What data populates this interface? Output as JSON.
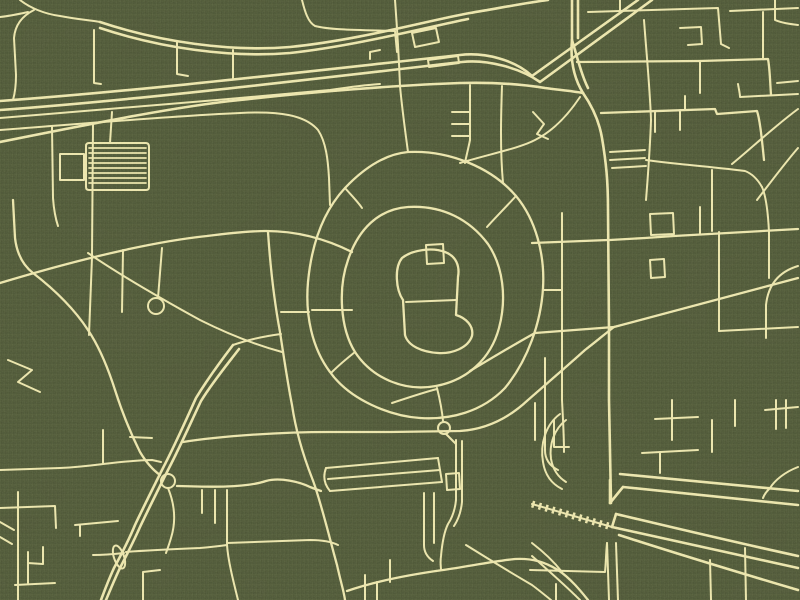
{
  "meta": {
    "description": "Stylized city street map art print, gold road network on olive-green canvas, no labels",
    "visible_text": []
  },
  "canvas": {
    "width": 800,
    "height": 600,
    "background_color": "#4e5736",
    "road_color": "#ebe5ac",
    "texture": "canvas-weave"
  },
  "map": {
    "layers": [
      {
        "name": "motorway-road",
        "stroke_width": 2.6,
        "paths": [
          "M0,101 C150,90 320,70 460,55 C485,52 515,60 532,76 L638,0",
          "M0,110 C150,99 320,78 462,62 C487,59 520,68 540,82 L652,0",
          "M100,22 C160,42 230,52 290,47 C360,40 430,20 470,13 C500,8 525,3 548,0",
          "M100,28 C160,48 230,58 290,53 C355,46 428,27 468,19",
          "M233,345 C220,362 207,380 196,398 C186,420 175,445 163,468 C152,490 143,508 135,525 C128,542 121,555 114,568 C108,581 104,592 101,600",
          "M239,349 C226,366 212,383 201,401 C191,422 180,447 168,470 C157,492 148,510 140,527 C132,545 125,558 119,570 C113,583 109,593 106,600",
          "M583,93 C592,106 599,120 602,138 C606,162 608,180 608,210 L609,330 L609,400 L611,503",
          "M0,142 C100,122 180,106 240,100 C310,92 400,85 460,83 C495,82 520,84 545,88 C560,90 572,91 583,93",
          "M572,0 L572,40 C570,62 575,80 583,93",
          "M578,0 L578,38",
          "M572,40 C578,60 582,76 588,88",
          "M620,474 L798,491",
          "M623,487 L798,505",
          "M612,527 C640,533 700,547 798,568",
          "M616,514 C650,522 720,539 798,556",
          "M619,535 C650,545 720,567 798,590",
          "M610,480 L610,503",
          "M612,527 L616,514",
          "M610,503 L623,487"
        ]
      },
      {
        "name": "primary-road",
        "stroke_width": 2.3,
        "paths": [
          "M408,152 C450,150 492,168 516,196 C536,220 545,255 543,288 C541,322 528,360 505,388 C482,412 450,420 420,418 C390,416 350,400 330,372 C312,348 305,315 308,282 C311,250 320,215 345,188 C365,167 386,154 408,152 Z",
          "M408,207 C443,205 470,220 488,244 C503,266 507,298 499,328 C491,358 468,380 436,386 C404,392 372,378 355,352 C340,328 338,288 348,260 C358,230 378,209 408,207 Z",
          "M402,258 C412,250 432,247 445,252 C456,256 460,266 458,277 L456,315 C466,318 474,326 472,336 C468,348 452,354 438,353 C422,352 408,346 405,335 L403,300 C396,290 394,268 402,258 Z",
          "M0,283 C60,265 140,243 207,236 C230,233 250,231 266,231 C290,231 320,236 352,252",
          "M268,232 C270,262 274,300 280,332 C285,365 288,385 292,405 C296,432 303,455 312,478 C320,498 330,540 337,565 C341,583 344,592 345,600",
          "M13,200 L15,238 C17,255 24,266 33,273 C55,290 75,310 88,330 C100,348 108,368 115,390 C122,412 130,432 140,452 C146,462 153,470 160,475",
          "M183,442 C220,436 280,432 330,432 L390,432 L460,431 C490,429 512,415 528,400 C545,385 565,368 585,350 C598,340 606,333 614,327",
          "M470,371 C495,356 515,344 535,333 L614,327 L798,278",
          "M347,591 C370,583 400,576 443,570 C470,566 495,561 515,559 C532,558 545,562 558,570 C570,578 580,590 588,600",
          "M177,486 C210,487 245,488 266,481 C280,477 300,482 310,487 C315,489 318,490 321,491",
          "M532,243 L608,240 M610,240 L645,238 L674,236 L798,229",
          "M577,62 L700,61 L768,59 C770,70 770,82 771,95",
          "M601,113 L715,109 L717,114 L757,111 C760,120 762,140 764,160"
        ]
      },
      {
        "name": "minor-road",
        "stroke_width": 2.0,
        "paths": [
          "M52,127 L53,198 C54,212 56,220 58,226",
          "M93,125 L92,257 M92,257 L89,335",
          "M123,250 L122,312",
          "M88,253 C120,275 160,298 200,320 C230,335 260,346 282,352",
          "M158,298 L162,248",
          "M8,360 L32,370 L18,382 L40,392",
          "M0,118 C100,110 220,100 330,90 C350,87 365,85 380,84",
          "M0,130 C80,124 170,116 240,113 C280,111 305,115 318,130 C326,142 328,160 329,178 L330,205",
          "M89,143 L146,143 Q149,143 149,147 L149,187 Q149,190 146,190 L89,190 Q86,190 86,187 L86,146 Q86,143 89,143",
          "M60,154 L84,154 L84,180 L60,180 Z",
          "M110,143 L112,112",
          "M94,30 L94,83 L101,84",
          "M177,42 L177,74 L188,76",
          "M233,50 L233,79",
          "M20,0 C30,8 45,14 60,16 C75,19 88,20 100,22",
          "M34,10 C22,16 15,25 14,38 L16,75 C16,84 15,93 13,100",
          "M0,17 C10,16 19,14 28,12",
          "M302,0 C305,12 308,22 315,26 C330,30 360,30 395,31 L397,52",
          "M395,0 C398,40 399,60 400,86 C402,108 405,130 408,152",
          "M470,85 L470,140 M452,112 L470,112 M452,124 L470,124 M452,136 L470,136 M470,140 C468,150 466,157 465,163",
          "M460,163 C490,154 520,148 535,140 C555,130 570,112 580,97",
          "M502,86 C501,115 500,150 503,183",
          "M588,12 L718,8 C719,20 720,32 721,44 L729,48",
          "M620,0 L620,11",
          "M730,11 L798,8",
          "M763,12 L763,58",
          "M680,28 L701,27 L702,44 L688,45",
          "M644,20 C647,60 650,90 651,120 C650,150 648,175 646,200",
          "M700,62 L700,93",
          "M685,96 L685,110",
          "M738,84 C739,90 740,94 740,97 L798,94",
          "M777,83 L798,81",
          "M732,164 C755,145 775,126 798,109",
          "M757,200 C770,183 785,163 798,148",
          "M775,0 L775,20 C782,23 790,24 798,25",
          "M562,213 L562,400 C563,420 564,435 564,452",
          "M700,207 L700,234",
          "M719,232 L719,331",
          "M762,187 C766,196 768,212 769,232 L769,278",
          "M650,214 L673,213 L674,234 L651,235 Z",
          "M650,260 L664,259 L665,277 L651,278 Z",
          "M719,331 L798,327",
          "M798,266 C778,272 768,286 766,305 L766,338",
          "M543,290 L562,290",
          "M545,358 L545,450 C545,460 550,466 558,470",
          "M535,403 L535,440",
          "M554,420 L554,447 L569,447",
          "M642,453 L698,450 M660,452 L660,473",
          "M655,419 L698,417",
          "M672,400 L672,440",
          "M712,420 L712,452",
          "M735,400 L735,426",
          "M765,410 L798,407",
          "M776,400 L776,429 M786,400 L786,428",
          "M798,467 C785,472 775,480 770,488 C766,492 764,495 763,498",
          "M607,543 L609,600 M616,543 L618,600",
          "M530,570 L605,572 C606,562 606,553 607,543",
          "M556,584 L556,600",
          "M710,560 L711,600",
          "M745,548 L746,600",
          "M532,556 C550,572 565,585 580,600",
          "M532,543 C545,553 555,563 562,572",
          "M466,545 C490,560 515,575 532,585 C540,591 546,596 551,600",
          "M365,575 L365,600",
          "M377,582 L377,600",
          "M390,560 L390,582",
          "M424,493 L424,545 C424,552 427,557 433,561",
          "M434,493 L434,543",
          "M326,468 L438,458",
          "M328,479 L440,470",
          "M330,491 L442,482",
          "M438,458 L442,482 M326,468 C323,476 324,484 330,491",
          "M446,474 L459,473 L460,489 L447,490 Z",
          "M456,440 L456,500 C455,510 452,518 448,524 C444,532 442,545 441,556 C440,563 441,567 441,570",
          "M462,441 L462,502 C461,512 458,520 454,526",
          "M437,388 C440,400 442,410 443,421",
          "M446,434 C450,438 453,441 456,444",
          "M392,403 C410,397 425,392 437,389",
          "M560,414 C545,425 540,445 543,462 C545,475 552,484 562,489",
          "M566,420 C554,429 549,445 551,459 C553,470 558,477 566,482",
          "M168,488 C175,505 176,522 171,538 C169,545 167,550 166,553",
          "M93,555 C105,555 115,554 124,553",
          "M126,552 C150,550 175,549 200,548 C212,547 220,546 227,545",
          "M227,490 L227,545 C228,560 233,580 238,600",
          "M227,543 C255,542 285,541 310,540 C322,540 332,542 338,545",
          "M202,490 L202,513",
          "M215,490 L215,523",
          "M0,470 L60,468 C80,467 95,465 103,464 C120,462 140,460 152,460 L161,462",
          "M103,430 L103,464",
          "M130,437 L152,438",
          "M0,508 L55,506 L56,528",
          "M18,492 L18,600",
          "M0,522 L14,530 M0,537 L12,544",
          "M28,552 L28,583 M28,563 L43,564 L43,547",
          "M15,585 L55,583",
          "M75,525 L118,521 M80,525 L80,536",
          "M143,572 L143,600 M143,572 L160,570",
          "M312,310 L352,310",
          "M516,196 C505,208 495,218 487,227",
          "M355,352 C345,360 338,366 332,372",
          "M345,188 C352,196 358,202 362,208",
          "M281,312 L309,312",
          "M646,160 C660,162 670,163 680,164 C700,166 722,168 745,171 C753,174 758,180 762,187",
          "M712,170 L712,231",
          "M412,33 L436,28 L439,42 L415,47 Z",
          "M428,60 L458,56 L459,63 L429,67 Z",
          "M370,52 L380,50 M370,52 L370,59",
          "M533,112 L544,124 L537,134 L548,139",
          "M610,152 L645,150 M610,160 L645,158 M612,168 L646,166",
          "M655,112 L655,132 M680,110 L680,130",
          "M406,302 L456,300",
          "M426,245 L443,244 L444,263 L427,264 Z",
          "M233,345 C250,339 266,336 281,334"
        ]
      },
      {
        "name": "parking-hatch",
        "stroke_width": 1.7,
        "paths": [
          "M89,148 L146,148 M89,153 L146,153 M89,158 L146,158 M89,163 L146,163 M89,168 L146,168 M89,173 L146,173 M89,178 L146,178 M89,183 L146,183"
        ]
      }
    ],
    "circles": [
      {
        "name": "loop-street",
        "cx": 156,
        "cy": 306,
        "r": 8
      },
      {
        "name": "junction-roundabout",
        "cx": 168,
        "cy": 481,
        "r": 7
      },
      {
        "name": "ring-south-loop",
        "cx": 444,
        "cy": 428,
        "r": 6
      }
    ],
    "ellipses": [
      {
        "name": "highway-median-oval",
        "cx": 119,
        "cy": 557,
        "rx": 5,
        "ry": 12,
        "rotate": -19
      }
    ],
    "railway": {
      "name": "railway-line",
      "base_path": "M532,504 L612,527",
      "tie_width": 7,
      "tie_dash": "2.5 4.5",
      "rail_width": 2
    }
  }
}
